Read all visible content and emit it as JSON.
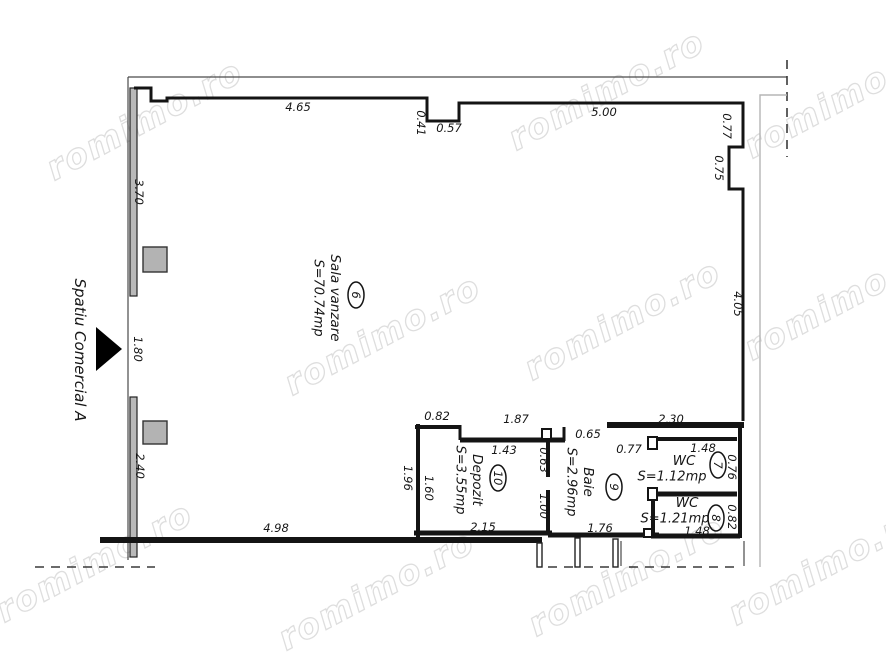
{
  "watermark": {
    "text": "romimo.ro",
    "color": "#d9d9d9"
  },
  "exterior_space": {
    "label": "Spatiu Comercial A"
  },
  "rooms": {
    "sala": {
      "number": "6",
      "name": "Sala vanzare",
      "area": "S=70.74mp"
    },
    "wc7": {
      "number": "7",
      "name": "WC",
      "area": "S=1.12mp"
    },
    "wc8": {
      "number": "8",
      "name": "WC",
      "area": "S=1.21mp"
    },
    "baie": {
      "number": "9",
      "name": "Baie",
      "area": "S=2.96mp"
    },
    "depozit": {
      "number": "10",
      "name": "Depozit",
      "area": "S=3.55mp"
    }
  },
  "dimension_labels": [
    {
      "text": "4.65",
      "x": 298,
      "y": 107,
      "rot": 0
    },
    {
      "text": "0.41",
      "x": 421,
      "y": 123,
      "rot": 90
    },
    {
      "text": "0.57",
      "x": 449,
      "y": 128,
      "rot": 0
    },
    {
      "text": "5.00",
      "x": 604,
      "y": 112,
      "rot": 0
    },
    {
      "text": "0.77",
      "x": 727,
      "y": 126,
      "rot": 90
    },
    {
      "text": "0.75",
      "x": 719,
      "y": 168,
      "rot": 90
    },
    {
      "text": "4.05",
      "x": 738,
      "y": 304,
      "rot": 90
    },
    {
      "text": "3.70",
      "x": 139,
      "y": 192,
      "rot": 90
    },
    {
      "text": "1.80",
      "x": 138,
      "y": 349,
      "rot": 90
    },
    {
      "text": "2.40",
      "x": 140,
      "y": 466,
      "rot": 90
    },
    {
      "text": "0.82",
      "x": 437,
      "y": 416,
      "rot": 0
    },
    {
      "text": "1.87",
      "x": 516,
      "y": 419,
      "rot": 0
    },
    {
      "text": "1.43",
      "x": 504,
      "y": 450,
      "rot": 0
    },
    {
      "text": "0.65",
      "x": 588,
      "y": 434,
      "rot": 0
    },
    {
      "text": "2.30",
      "x": 671,
      "y": 419,
      "rot": 0
    },
    {
      "text": "0.77",
      "x": 629,
      "y": 449,
      "rot": 0
    },
    {
      "text": "1.48",
      "x": 703,
      "y": 448,
      "rot": 0
    },
    {
      "text": "0.76",
      "x": 732,
      "y": 467,
      "rot": 90
    },
    {
      "text": "0.82",
      "x": 732,
      "y": 517,
      "rot": 90
    },
    {
      "text": "1.48",
      "x": 697,
      "y": 531,
      "rot": 0
    },
    {
      "text": "1.76",
      "x": 600,
      "y": 528,
      "rot": 0
    },
    {
      "text": "2.15",
      "x": 483,
      "y": 527,
      "rot": 0
    },
    {
      "text": "4.98",
      "x": 276,
      "y": 528,
      "rot": 0
    },
    {
      "text": "1.96",
      "x": 408,
      "y": 478,
      "rot": 90
    },
    {
      "text": "1.60",
      "x": 429,
      "y": 488,
      "rot": 90
    },
    {
      "text": "0.63",
      "x": 544,
      "y": 460,
      "rot": 90
    },
    {
      "text": "1.00",
      "x": 544,
      "y": 506,
      "rot": 90
    }
  ]
}
